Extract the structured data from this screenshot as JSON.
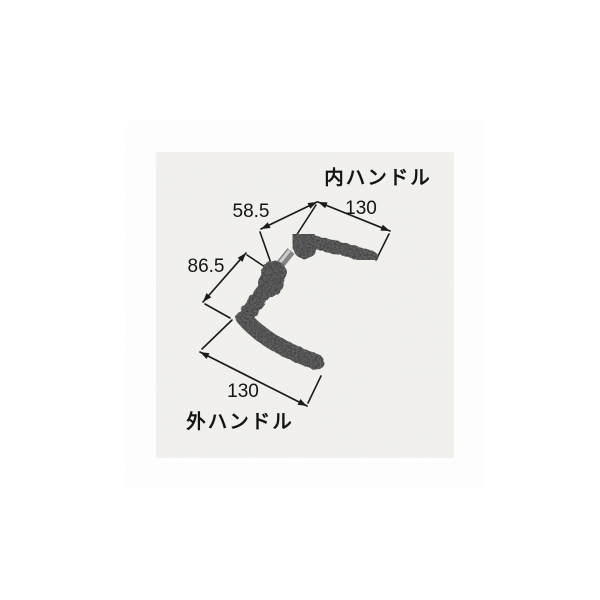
{
  "diagram": {
    "title_context": "lever handle dimension drawing",
    "inner_handle": {
      "label": "内ハンドル",
      "length_dim": "130",
      "offset_dim": "58.5"
    },
    "outer_handle": {
      "label": "外ハンドル",
      "length_dim": "130",
      "offset_dim": "86.5"
    }
  },
  "colors": {
    "background": "#ffffff",
    "photo_background": "#f2f1ee",
    "handle": "#1f1f1f",
    "spindle": "#848484",
    "spindle_highlight": "#cccccc",
    "line": "#1b1b1b",
    "text": "#141414"
  }
}
